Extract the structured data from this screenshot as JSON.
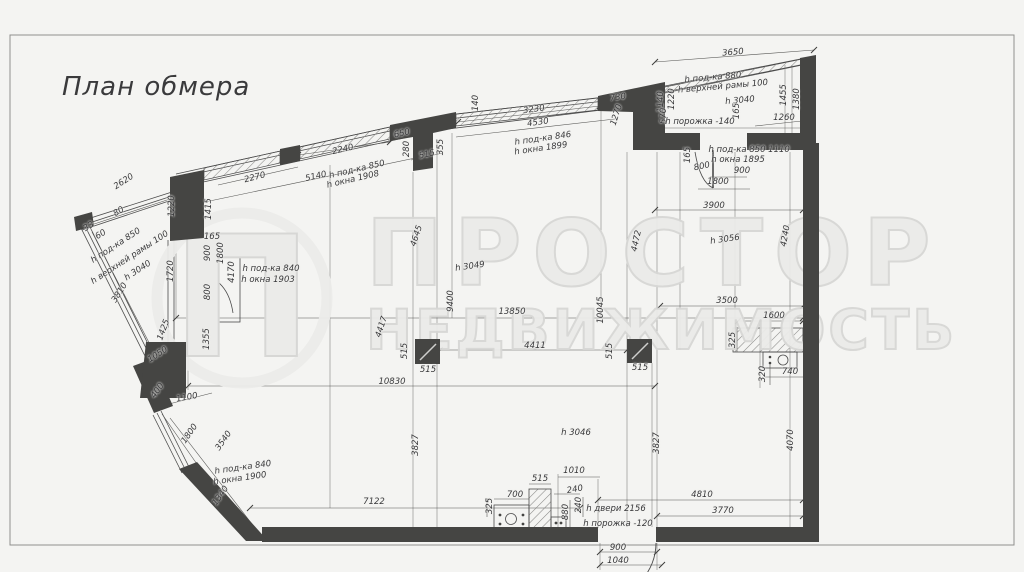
{
  "page": {
    "title": "План обмера"
  },
  "watermark": {
    "logo_letter": "П",
    "line1": "ПРОСТОР",
    "line2": "НЕДВИЖИМОСТЬ"
  },
  "colors": {
    "bg": "#f4f4f2",
    "wall": "#454543",
    "line": "#4a4a4a",
    "dim": "#38383a",
    "wm": "#ebebe9",
    "wmstroke": "#d7d7d5"
  },
  "plan": {
    "labels": [
      {
        "t": "2620",
        "x": 124,
        "y": 182,
        "r": -33
      },
      {
        "t": "80",
        "x": 119,
        "y": 212,
        "r": -33
      },
      {
        "t": "33",
        "x": 89,
        "y": 227,
        "r": -33
      },
      {
        "t": "60",
        "x": 101,
        "y": 235,
        "r": -33
      },
      {
        "t": "h под-ка 850",
        "x": 116,
        "y": 246,
        "r": -33
      },
      {
        "t": "h верхней рамы 100",
        "x": 130,
        "y": 258,
        "r": -33
      },
      {
        "t": "h 3040",
        "x": 138,
        "y": 271,
        "r": -33
      },
      {
        "t": "3810",
        "x": 120,
        "y": 293,
        "r": -57
      },
      {
        "t": "1220",
        "x": 172,
        "y": 206,
        "r": -90
      },
      {
        "t": "1415",
        "x": 209,
        "y": 209,
        "r": -90
      },
      {
        "t": "1720",
        "x": 171,
        "y": 271,
        "r": -90
      },
      {
        "t": "1425",
        "x": 164,
        "y": 330,
        "r": -70
      },
      {
        "t": "1050",
        "x": 158,
        "y": 355,
        "r": -33
      },
      {
        "t": "1355",
        "x": 207,
        "y": 339,
        "r": -90
      },
      {
        "t": "165",
        "x": 212,
        "y": 237,
        "r": 0
      },
      {
        "t": "900",
        "x": 208,
        "y": 253,
        "r": -90
      },
      {
        "t": "1800",
        "x": 221,
        "y": 253,
        "r": -90
      },
      {
        "t": "800",
        "x": 208,
        "y": 292,
        "r": -90
      },
      {
        "t": "4170",
        "x": 232,
        "y": 272,
        "r": -90
      },
      {
        "t": "h под-ка 840",
        "x": 271,
        "y": 269,
        "r": 0
      },
      {
        "t": "h окна 1903",
        "x": 268,
        "y": 280,
        "r": 0
      },
      {
        "t": "2270",
        "x": 255,
        "y": 178,
        "r": -14
      },
      {
        "t": "2240",
        "x": 343,
        "y": 150,
        "r": -13
      },
      {
        "t": "5140",
        "x": 316,
        "y": 177,
        "r": -13
      },
      {
        "t": "h под-ка 850",
        "x": 357,
        "y": 170,
        "r": -13
      },
      {
        "t": "h окна 1908",
        "x": 353,
        "y": 180,
        "r": -13
      },
      {
        "t": "650",
        "x": 402,
        "y": 134,
        "r": -13
      },
      {
        "t": "280",
        "x": 407,
        "y": 149,
        "r": -90
      },
      {
        "t": "515",
        "x": 427,
        "y": 155,
        "r": -13
      },
      {
        "t": "355",
        "x": 441,
        "y": 147,
        "r": -90
      },
      {
        "t": "140",
        "x": 476,
        "y": 103,
        "r": -90
      },
      {
        "t": "3230",
        "x": 534,
        "y": 110,
        "r": -8
      },
      {
        "t": "4530",
        "x": 538,
        "y": 123,
        "r": -8
      },
      {
        "t": "h под-ка 846",
        "x": 543,
        "y": 139,
        "r": -8
      },
      {
        "t": "h окна 1899",
        "x": 541,
        "y": 149,
        "r": -8
      },
      {
        "t": "730",
        "x": 618,
        "y": 98,
        "r": -8
      },
      {
        "t": "1270",
        "x": 617,
        "y": 115,
        "r": -72
      },
      {
        "t": "3650",
        "x": 733,
        "y": 53,
        "r": -5
      },
      {
        "t": "h под-ка 880",
        "x": 713,
        "y": 78,
        "r": -5
      },
      {
        "t": "h верхней рамы 100",
        "x": 723,
        "y": 87,
        "r": -5
      },
      {
        "t": "h 3040",
        "x": 740,
        "y": 101,
        "r": -5
      },
      {
        "t": "165",
        "x": 737,
        "y": 111,
        "r": -90
      },
      {
        "t": "1140",
        "x": 661,
        "y": 102,
        "r": -90
      },
      {
        "t": "1220",
        "x": 672,
        "y": 99,
        "r": -90
      },
      {
        "t": "570",
        "x": 664,
        "y": 116,
        "r": -90
      },
      {
        "t": "1455",
        "x": 784,
        "y": 95,
        "r": -90
      },
      {
        "t": "1380",
        "x": 797,
        "y": 99,
        "r": -90
      },
      {
        "t": "1260",
        "x": 784,
        "y": 118,
        "r": 0
      },
      {
        "t": "h порожка -140",
        "x": 700,
        "y": 122,
        "r": 0
      },
      {
        "t": "165",
        "x": 688,
        "y": 155,
        "r": -90
      },
      {
        "t": "800",
        "x": 702,
        "y": 167,
        "r": -12
      },
      {
        "t": "900",
        "x": 742,
        "y": 171,
        "r": 0
      },
      {
        "t": "h под-ка 850",
        "x": 737,
        "y": 150,
        "r": 0
      },
      {
        "t": "h окна 1895",
        "x": 738,
        "y": 160,
        "r": 0
      },
      {
        "t": "1800",
        "x": 718,
        "y": 182,
        "r": 0
      },
      {
        "t": "1110",
        "x": 779,
        "y": 150,
        "r": 0
      },
      {
        "t": "3900",
        "x": 714,
        "y": 206,
        "r": 0
      },
      {
        "t": "h 3056",
        "x": 725,
        "y": 240,
        "r": -8
      },
      {
        "t": "4240",
        "x": 786,
        "y": 236,
        "r": -80
      },
      {
        "t": "3500",
        "x": 727,
        "y": 301,
        "r": 0
      },
      {
        "t": "1600",
        "x": 774,
        "y": 316,
        "r": 0
      },
      {
        "t": "325",
        "x": 733,
        "y": 340,
        "r": -90
      },
      {
        "t": "320",
        "x": 763,
        "y": 374,
        "r": -90
      },
      {
        "t": "740",
        "x": 790,
        "y": 372,
        "r": 0
      },
      {
        "t": "4070",
        "x": 791,
        "y": 440,
        "r": -90
      },
      {
        "t": "4645",
        "x": 417,
        "y": 236,
        "r": -72
      },
      {
        "t": "h 3049",
        "x": 470,
        "y": 267,
        "r": -8
      },
      {
        "t": "9400",
        "x": 451,
        "y": 301,
        "r": -90
      },
      {
        "t": "13850",
        "x": 512,
        "y": 312,
        "r": 0
      },
      {
        "t": "10045",
        "x": 601,
        "y": 310,
        "r": -90
      },
      {
        "t": "4472",
        "x": 637,
        "y": 241,
        "r": -78
      },
      {
        "t": "4417",
        "x": 382,
        "y": 327,
        "r": -72
      },
      {
        "t": "515",
        "x": 405,
        "y": 351,
        "r": -90
      },
      {
        "t": "515",
        "x": 428,
        "y": 370,
        "r": 0
      },
      {
        "t": "515",
        "x": 610,
        "y": 351,
        "r": -90
      },
      {
        "t": "515",
        "x": 640,
        "y": 368,
        "r": 0
      },
      {
        "t": "4411",
        "x": 535,
        "y": 346,
        "r": 0
      },
      {
        "t": "10830",
        "x": 392,
        "y": 382,
        "r": 0
      },
      {
        "t": "3827",
        "x": 416,
        "y": 445,
        "r": -90
      },
      {
        "t": "3827",
        "x": 657,
        "y": 443,
        "r": -90
      },
      {
        "t": "h 3046",
        "x": 576,
        "y": 433,
        "r": 0
      },
      {
        "t": "7122",
        "x": 374,
        "y": 502,
        "r": 0
      },
      {
        "t": "4810",
        "x": 702,
        "y": 495,
        "r": 0
      },
      {
        "t": "3770",
        "x": 723,
        "y": 511,
        "r": 0
      },
      {
        "t": "400",
        "x": 158,
        "y": 391,
        "r": -55
      },
      {
        "t": "1100",
        "x": 187,
        "y": 398,
        "r": -10
      },
      {
        "t": "1800",
        "x": 190,
        "y": 434,
        "r": -55
      },
      {
        "t": "3540",
        "x": 224,
        "y": 441,
        "r": -55
      },
      {
        "t": "1340",
        "x": 221,
        "y": 496,
        "r": -55
      },
      {
        "t": "h под-ка 840",
        "x": 243,
        "y": 468,
        "r": -8
      },
      {
        "t": "h окна 1900",
        "x": 240,
        "y": 479,
        "r": -8
      },
      {
        "t": "325",
        "x": 490,
        "y": 506,
        "r": -90
      },
      {
        "t": "700",
        "x": 515,
        "y": 495,
        "r": 0
      },
      {
        "t": "515",
        "x": 540,
        "y": 479,
        "r": 0
      },
      {
        "t": "1010",
        "x": 574,
        "y": 471,
        "r": 0
      },
      {
        "t": "240",
        "x": 575,
        "y": 490,
        "r": -10
      },
      {
        "t": "880",
        "x": 566,
        "y": 512,
        "r": -90
      },
      {
        "t": "240",
        "x": 579,
        "y": 505,
        "r": -90
      },
      {
        "t": "h двери 2156",
        "x": 616,
        "y": 509,
        "r": 0
      },
      {
        "t": "h порожка -120",
        "x": 618,
        "y": 524,
        "r": 0
      },
      {
        "t": "900",
        "x": 618,
        "y": 548,
        "r": 0
      },
      {
        "t": "1040",
        "x": 618,
        "y": 561,
        "r": 0
      }
    ]
  }
}
